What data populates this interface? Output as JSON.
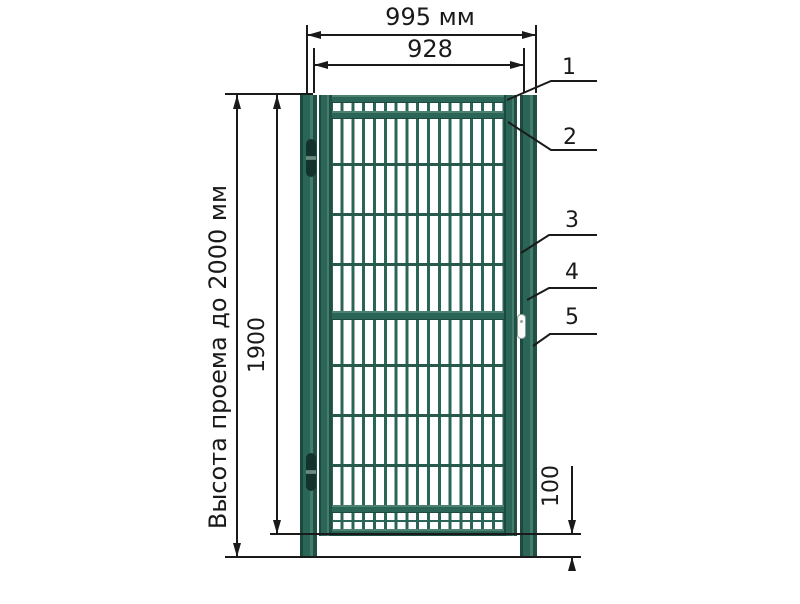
{
  "dimensions": {
    "width_outer": "995 мм",
    "width_inner": "928",
    "height_outer_label": "Высота проема до 2000 мм",
    "height_inner": "1900",
    "bottom_gap": "100"
  },
  "callouts": [
    "1",
    "2",
    "3",
    "4",
    "5"
  ],
  "colors": {
    "frame_green": "#2b6557",
    "frame_dark": "#1d4a3f",
    "frame_light": "#457d6c",
    "frame_shadow": "#224f44",
    "hinge_dark": "#12332b",
    "lock_white": "#fafafa",
    "line_black": "#1a1a1a"
  }
}
